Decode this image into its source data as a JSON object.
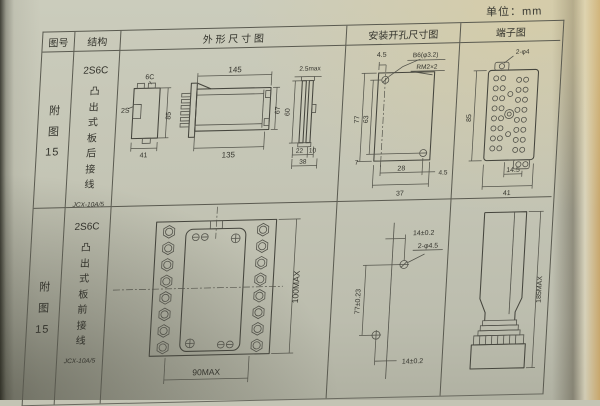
{
  "page": {
    "unit": "单位：mm"
  },
  "header": {
    "fig_no": "图号",
    "structure": "结构",
    "outline": "外 形 尺 寸 图",
    "mounting": "安装开孔尺寸图",
    "terminal": "端子图"
  },
  "rows": [
    {
      "fig_label": "附图",
      "fig_number": "15",
      "model": "2S6C",
      "structure_desc": "凸出式板后接线",
      "type_code": "JCX-10A/5",
      "outline": {
        "side_label_top": "6C",
        "side_label_left": "2S",
        "side_height": "85",
        "side_width": "41",
        "body_width_top": "145",
        "body_width_bottom": "135",
        "body_height": "67",
        "flange_thickness": "2.5max",
        "flange_height": "60",
        "flange_dim1": "22",
        "flange_dim2": "10",
        "flange_width": "38"
      },
      "mounting": {
        "offset_top": "4.5",
        "hole_label": "B6(φ3.2)",
        "thread_label": "RM2×2",
        "height_outer": "77",
        "height_inner": "63",
        "offset_bottom": "7",
        "width_inner": "28",
        "offset_right": "4.5",
        "width_outer": "37"
      },
      "terminal": {
        "hole_label": "2-φ4",
        "height": "85",
        "width_inner": "14.5",
        "width_outer": "41"
      }
    },
    {
      "fig_label": "附图",
      "fig_number": "15",
      "model": "2S6C",
      "structure_desc": "凸出式板前接线",
      "type_code": "JCX-10A/5",
      "outline": {
        "width": "90MAX",
        "height": "100MAX"
      },
      "mounting": {
        "offset_top": "14±0.2",
        "hole_label": "2-φ4.5",
        "height": "77±0.23",
        "offset_bottom": "14±0.2"
      },
      "terminal": {
        "height": "185MAX"
      }
    }
  ]
}
